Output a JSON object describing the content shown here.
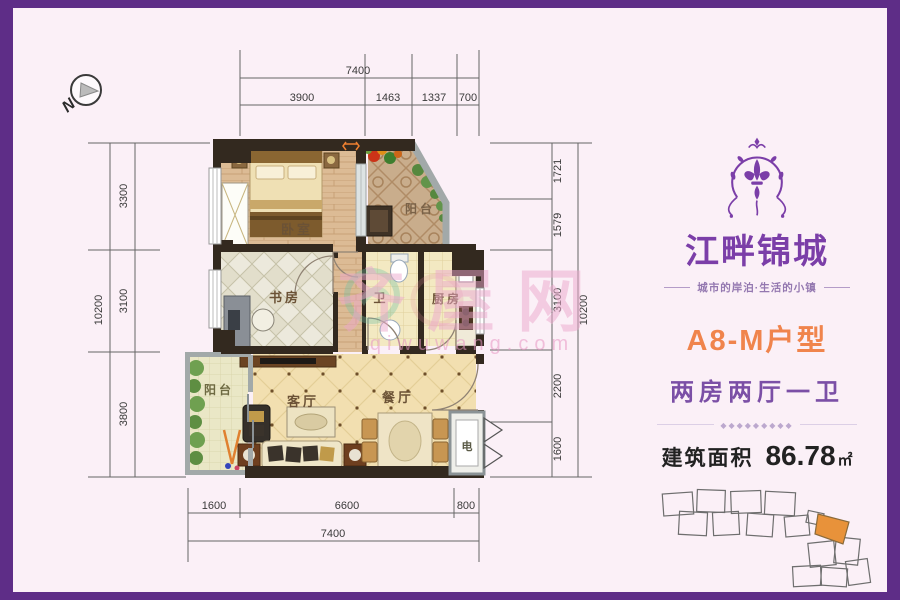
{
  "frame": {
    "border_color": "#5E2D87",
    "bg": "#FBF0F7"
  },
  "compass": {
    "label": "N"
  },
  "watermark": {
    "cn": "齐屋网",
    "en": "qiwuwang.com"
  },
  "plan": {
    "rooms": {
      "bedroom": "卧室",
      "balcony_top": "阳台",
      "study": "书房",
      "bath": "卫",
      "kitchen": "厨房",
      "living": "客厅",
      "dining": "餐厅",
      "balcony_bottom": "阳台",
      "elec": "电"
    },
    "dims": {
      "top": {
        "total": "7400",
        "segments": [
          "3900",
          "1463",
          "1337",
          "700"
        ]
      },
      "bottom": {
        "total": "7400",
        "segments": [
          "1600",
          "6600",
          "800"
        ]
      },
      "left": {
        "total": "10200",
        "segments": [
          "3300",
          "3100",
          "3800"
        ]
      },
      "right": {
        "total": "10200",
        "segments": [
          "1721",
          "1579",
          "3100",
          "2200",
          "1600"
        ]
      }
    }
  },
  "sidebar": {
    "brand": "江畔锦城",
    "tagline": "城市的岸泊·生活的小镇",
    "unit_title": "A8-M户型",
    "unit_layout": "两房两厅一卫",
    "divider_glyphs": "◆◆◆◆◆◆◆◆◆",
    "area_label": "建筑面积",
    "area_value": "86.78",
    "area_unit": "㎡",
    "accent_orange": "#F0844C",
    "accent_purple": "#7B3EA8"
  }
}
